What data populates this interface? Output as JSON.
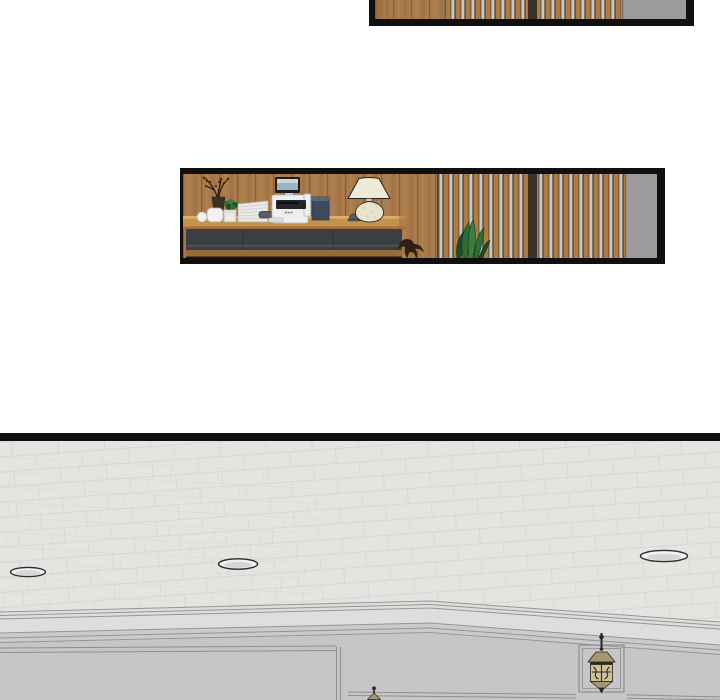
{
  "page": {
    "type": "webtoon-comic-page",
    "background": "#ffffff",
    "text_content": "none"
  },
  "panels": [
    {
      "id": "top-strip",
      "description": "thin cropped panel showing a wood-plank wall, a vertical wood-and-steel slat partition with a dark divider post, and a gray pillar",
      "objects": [
        "wood-wall",
        "slat-partition",
        "divider-post",
        "gray-pillar"
      ]
    },
    {
      "id": "reception-desk",
      "description": "reception desk scene: wood panel wall, charcoal-front desk with decor branch vase, white cups, mini potted plant, paper stack, stapler, printer-fax, navy box, call bell and ceramic table lamp; slat partition with snake plant and gray pillar on the right; office chair leg peeking past the desk",
      "objects": [
        "wood-wall",
        "branch-vase",
        "white-cup",
        "white-bowl",
        "mini-plant",
        "paper-stack",
        "stapler",
        "printer",
        "navy-box",
        "call-bell",
        "table-lamp",
        "desk",
        "chair-leg",
        "slat-partition",
        "snake-plant",
        "gray-pillar"
      ]
    },
    {
      "id": "lobby-ceiling",
      "description": "large panel looking up at a lobby: tiled ceiling with three recessed lights, crown molding, gray paneled wainscot wall with divider, framed lantern wall sconces",
      "objects": [
        "ceiling",
        "recessed-light",
        "recessed-light",
        "recessed-light",
        "crown-molding",
        "paneled-wall",
        "panel-divider",
        "lantern-sconce",
        "lantern-finial"
      ]
    }
  ],
  "colors": {
    "page_bg": "#ffffff",
    "black_ink": "#101010",
    "wood_base": "#a97a4a",
    "wood_dark": "#855a33",
    "wood_light": "#c08d58",
    "desk_top": "#c3924f",
    "desk_top_hi": "#ddae6e",
    "desk_edge": "#a0703a",
    "desk_front": "#3b3f45",
    "desk_front_hi": "#5c6167",
    "desk_plinth": "#996b3b",
    "floor_shadow": "#1e1812",
    "slat_base": "#564f47",
    "slat_wood": "#b27b3e",
    "slat_silver": "#c7c7c5",
    "slat_divider": "#38322a",
    "gray_panel": "#9b9b9d",
    "gray_panel_edge": "#6b6b6d",
    "ceiling": "#e6e4e1",
    "ceiling_line": "#cfcdca",
    "wall": "#c8c5c8",
    "molding_light": "#e0dedd",
    "molding_shade": "#cccacd",
    "line_gray": "#8f8d90",
    "lamp_shade": "#f1ead6",
    "lamp_base": "#e9e3cc",
    "printer_white": "#edeff0",
    "printer_dark": "#1b1c1e",
    "screen_blue": "#9db3bd",
    "screen_sky": "#cbd8dc",
    "navy_box": "#3d4a5c",
    "navy_box_top": "#54657c",
    "plant_green": "#2f6d35",
    "plant_green_mid": "#3c7c40",
    "plant_green_dark": "#1d4b24",
    "branch_dark": "#241a10",
    "berry_red": "#5a2418",
    "white_obj": "#f2f2f0",
    "obj_outline": "#b5b3ae",
    "paper": "#e9e9e7",
    "paper_line": "#c9c9c5",
    "metal_gray": "#5a5e63",
    "lantern_body": "#cfc294",
    "lantern_roof": "#a89670",
    "lantern_dark": "#2b2620",
    "claw_brown": "#2e2013",
    "outline_dark": "#23221f"
  }
}
